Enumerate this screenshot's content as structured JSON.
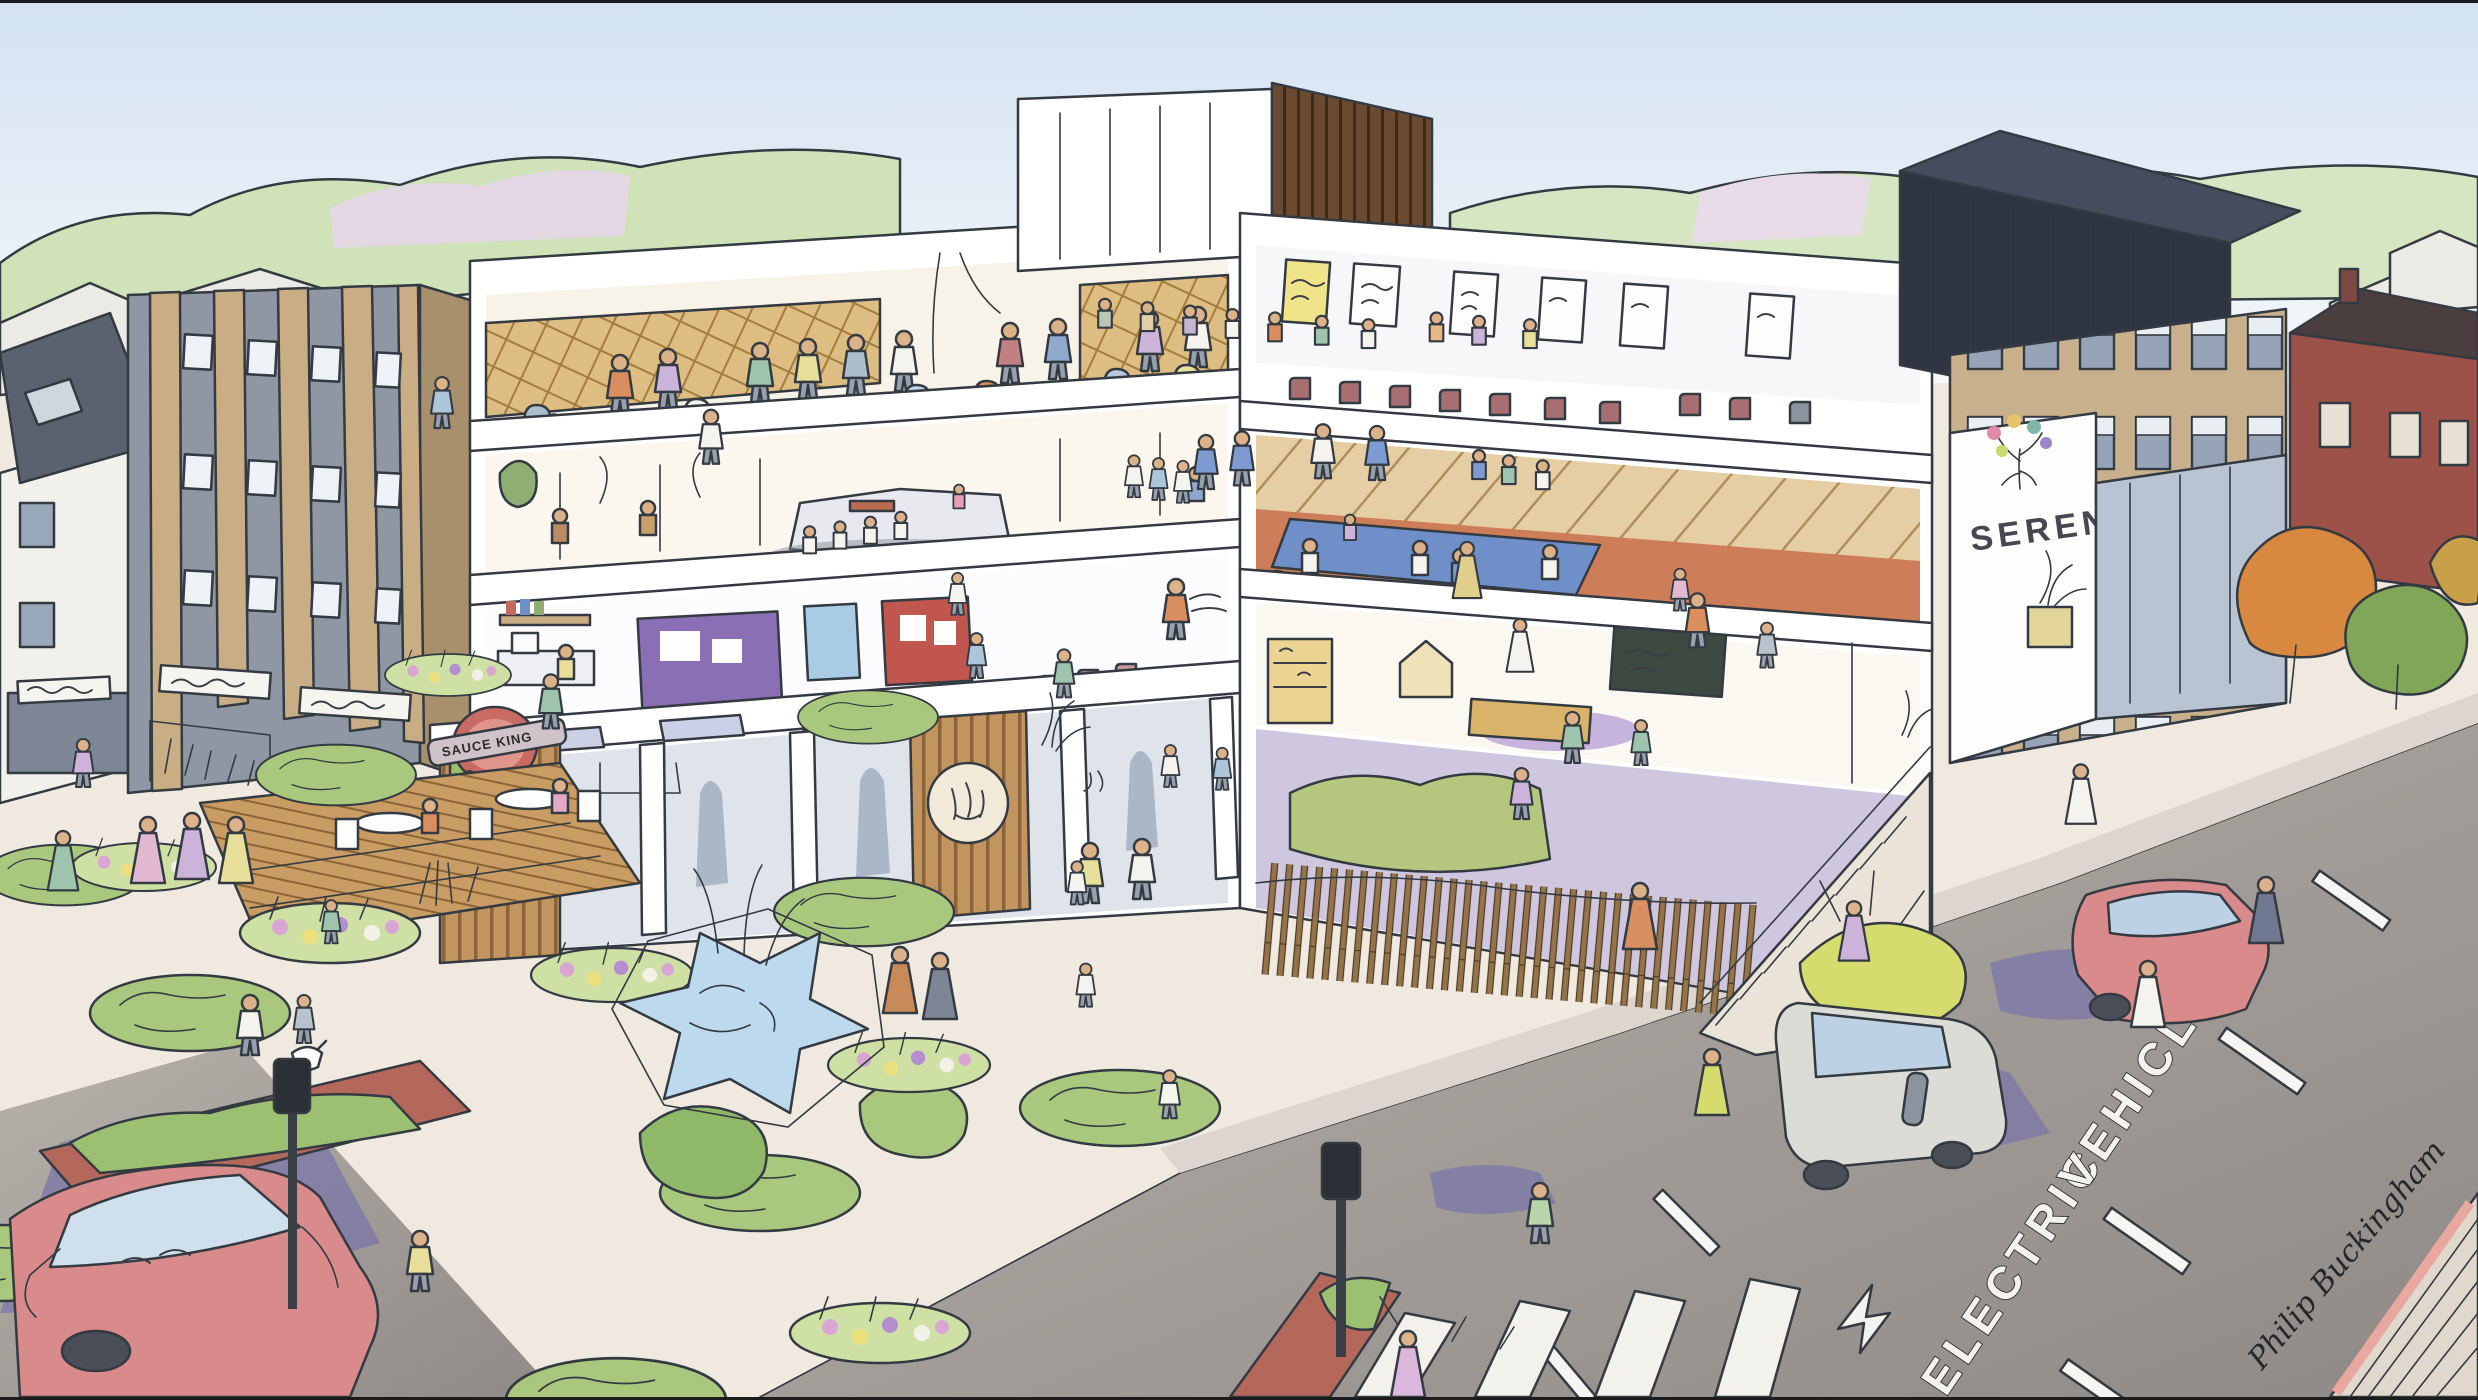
{
  "artwork": {
    "kind": "hand-drawn architectural concept illustration",
    "scene": "mixed-use community centre with cutaway floors, islamic garden plaza, street with electric vehicle lane",
    "signs": {
      "shop_roundel_text": "SAUCE KING",
      "entrance_logo_text": "SERENE",
      "road_marking_word1": "ELECTRIC",
      "road_marking_word2": "VEHICLES",
      "artist_signature": "Philip Buckingham"
    },
    "icons": {
      "shop_roundel": "red-roundel-sign",
      "arabic_roundel": "arabic-calligraphy-roundel",
      "serene_logo": "colourful-tree-logo",
      "left_shop_signs": "illegible-handwritten-signboards",
      "seminar_posters": "scribbled-wall-posters",
      "road_arrow": "lane-direction-arrow"
    },
    "palette": {
      "sky_top": "#d3e2f2",
      "sky_bottom": "#fdfdfc",
      "treeline": "#cfe2b8",
      "plaza": "#efe9e0",
      "road": "#aaa49e",
      "shadow_purple": "#7b76a8",
      "white_building": "#ffffff",
      "timber": "#c2945f",
      "tan_brick": "#c9b08c",
      "glazing": "#9aa8bb",
      "hedge_green": "#a9c87d",
      "hedge_dark": "#7fa757",
      "water_blue": "#bcd9ee",
      "dojo_floor": "#cd7e58",
      "dojo_mat": "#6f8fc9",
      "chair_maroon": "#a86f72",
      "car_red": "#d98a8a",
      "van_grey": "#dcdcd6",
      "navy_roof": "#2e3442",
      "roundel_red": "#c96b63"
    }
  }
}
